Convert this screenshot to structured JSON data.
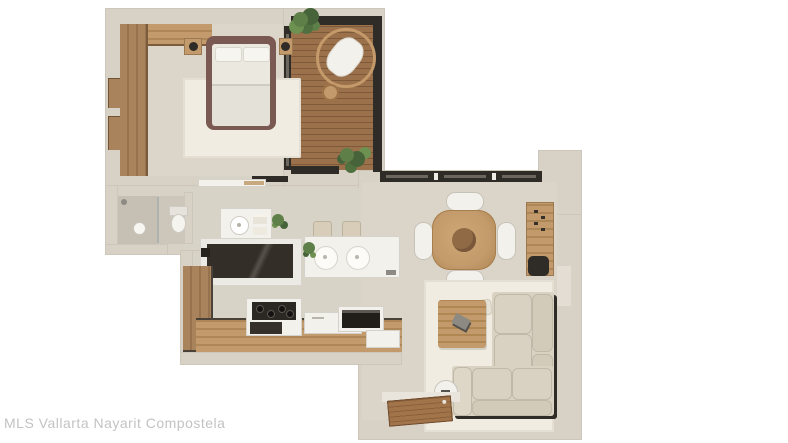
{
  "watermark": {
    "text": "MLS Vallarta Nayarit Compostela"
  },
  "palette": {
    "background": "#ffffff",
    "wall": "#d8d1c6",
    "wall_inner": "#cfc8bd",
    "floor_bedroom": "#dcd6ca",
    "floor_hall": "#d8d3c7",
    "floor_living": "#dbd5c9",
    "floor_bath": "#cdc7bb",
    "shower_floor": "#c6c0b4",
    "deck_wood": "#9a714b",
    "deck_plank_line": "#7e5a3a",
    "wood_light": "#c29a6b",
    "wood_mid": "#a8835c",
    "wood_dark": "#8a6844",
    "bed_frame": "#7a5952",
    "mattress": "#ebe8e0",
    "rug": "#f0ece1",
    "sofa": "#d9d2c2",
    "sofa_seam": "#c1b9a8",
    "dark_frame": "#2f2b26",
    "white_furniture": "#f3f1ec",
    "plant_green": "#5f7f48",
    "plant_green_dark": "#46633a",
    "plant_green_light": "#6d9150",
    "steel": "#8d8a84",
    "watermark": "#c3c3c3"
  },
  "icons": {
    "bed": "double-bed-top-view",
    "hanging_chair": "rattan-hanging-chair",
    "dining_table": "round-dining-table-4-chairs",
    "sofa": "l-shaped-sectional-sofa",
    "stove": "four-burner-cooktop",
    "toilet": "toilet-top-view",
    "sink": "round-basin",
    "door": "open-entry-door"
  }
}
